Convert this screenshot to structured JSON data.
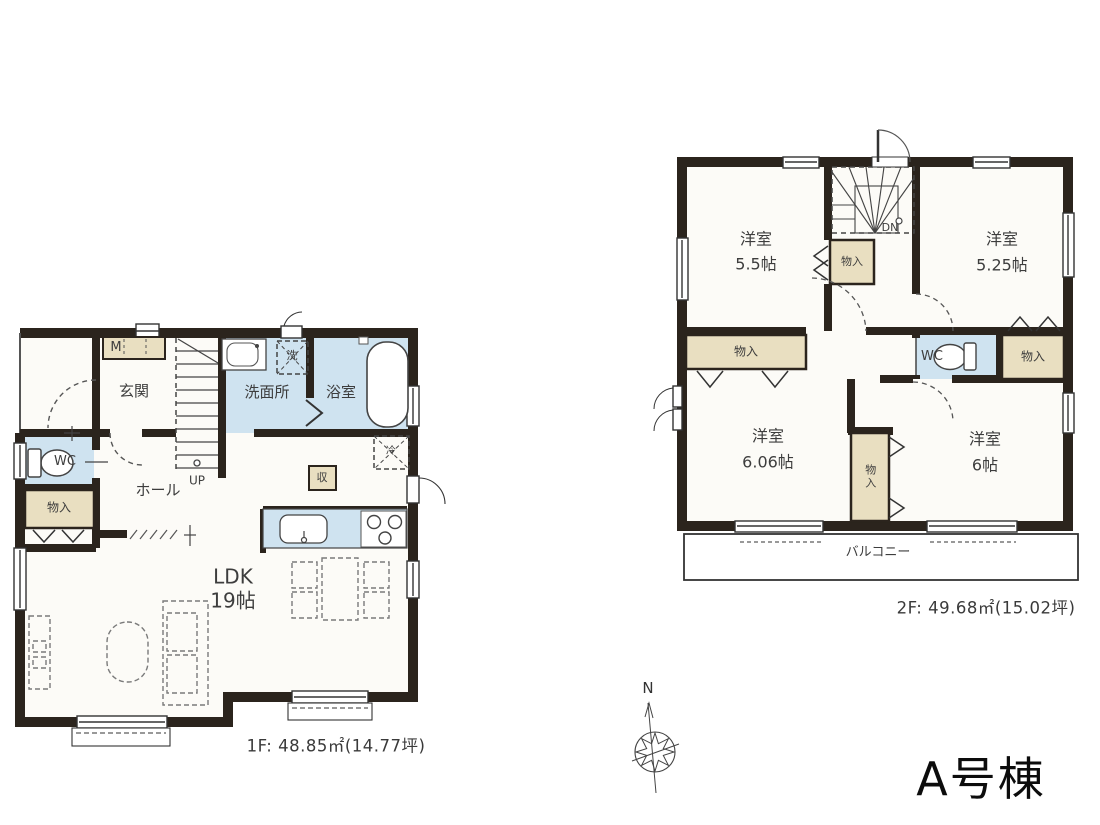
{
  "building": {
    "name": "A号棟"
  },
  "compass": {
    "north_label": "N"
  },
  "colors": {
    "wall": "#2b241d",
    "wet_area": "#cfe3f0",
    "closet_fill": "#e9dfc1",
    "floor": "#fcfbf7"
  },
  "floor1": {
    "caption": "1F: 48.85㎡(14.77坪)",
    "labels": {
      "meter_box": "M",
      "entrance": "玄関",
      "hall": "ホール",
      "washroom": "洗面所",
      "bathroom": "浴室",
      "washer": "洗",
      "wc": "WC",
      "storage": "物入",
      "stairs_up": "UP",
      "pantry": "収",
      "fridge": "冷",
      "ldk_line1": "LDK",
      "ldk_line2": "19帖"
    }
  },
  "floor2": {
    "caption": "2F: 49.68㎡(15.02坪)",
    "labels": {
      "room_a_line1": "洋室",
      "room_a_line2": "5.5帖",
      "room_b_line1": "洋室",
      "room_b_line2": "5.25帖",
      "room_c_line1": "洋室",
      "room_c_line2": "6.06帖",
      "room_d_line1": "洋室",
      "room_d_line2": "6帖",
      "closet_a": "物入",
      "closet_b": "物入",
      "closet_c": "物入",
      "closet_d": "物入",
      "wc": "WC",
      "stairs_dn": "DN",
      "balcony": "バルコニー"
    }
  }
}
